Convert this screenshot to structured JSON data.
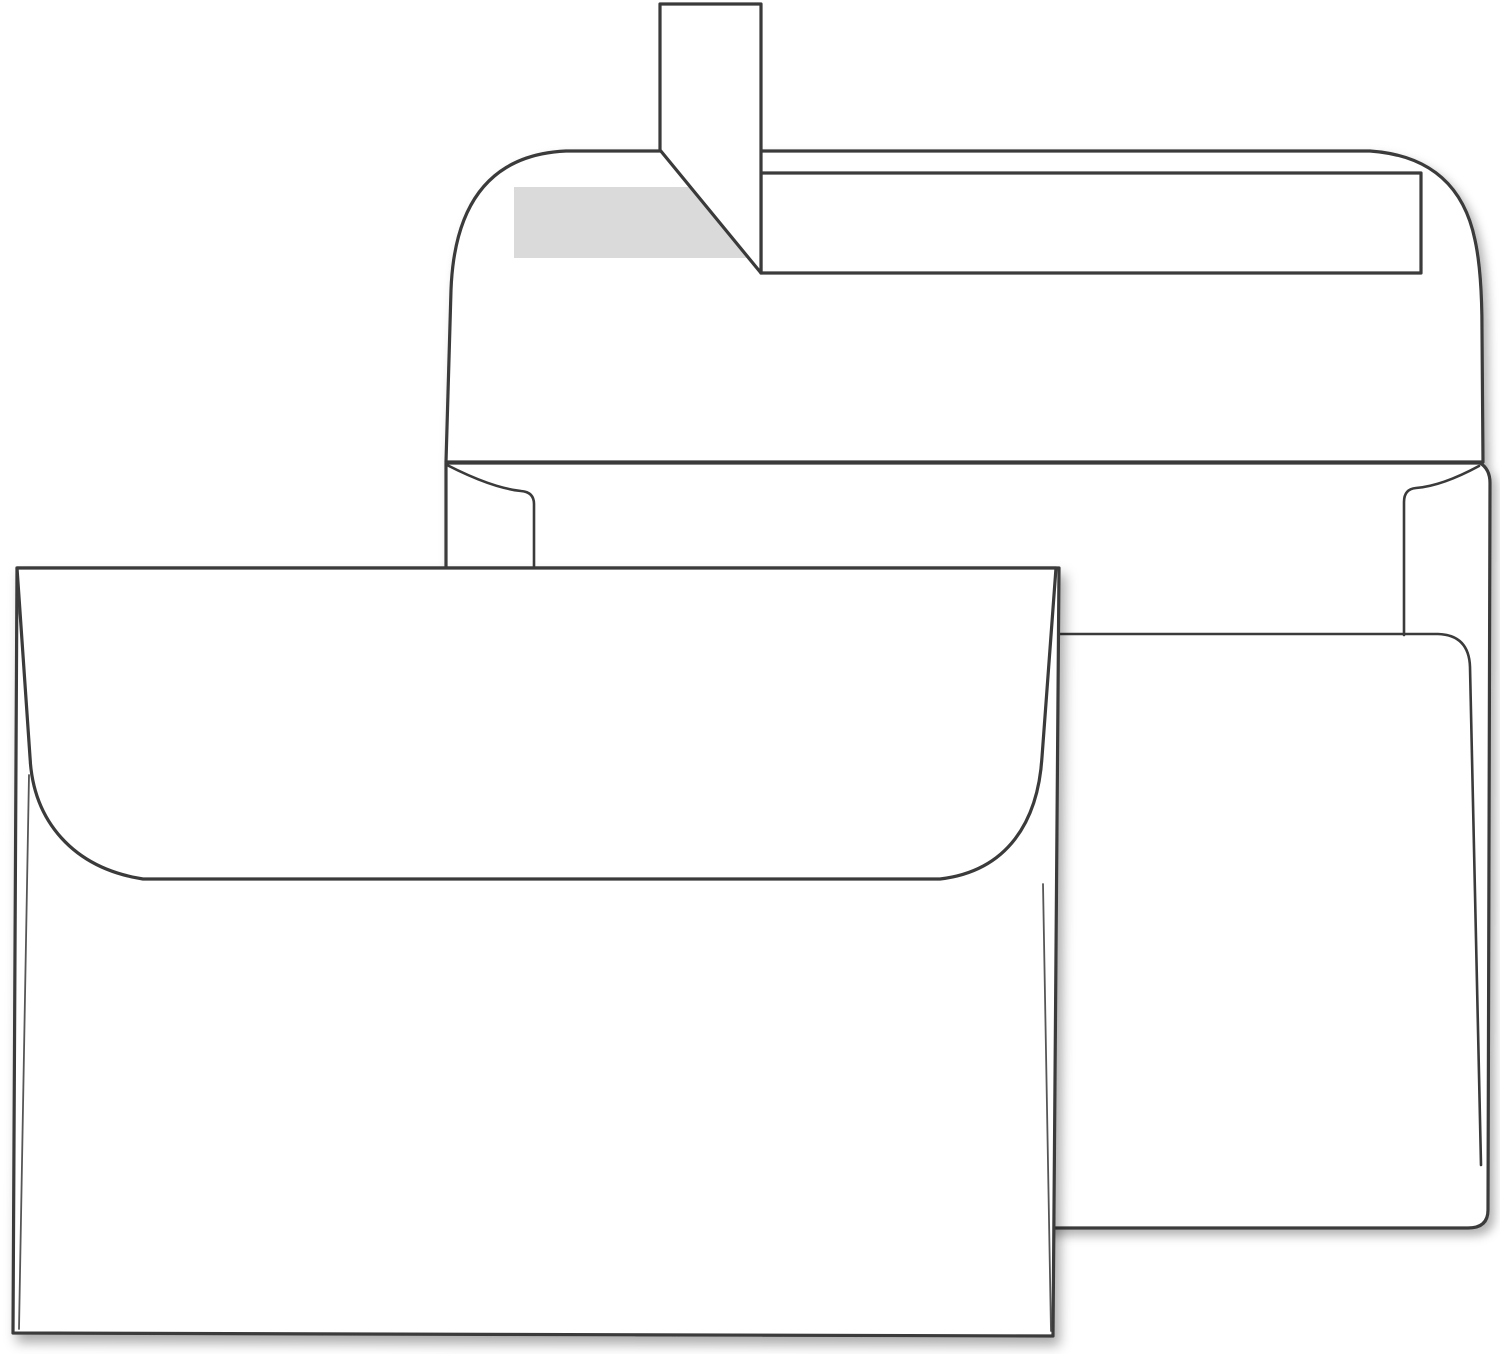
{
  "scene": {
    "title": "Two blank white envelopes product illustration",
    "background_color": "#ffffff",
    "paper_color": "#ffffff",
    "outline_color": "#3a3a3a",
    "adhesive_color": "#dadada",
    "back_envelope": {
      "view": "back side with flap open upward",
      "features": [
        "peel-and-seal release strip lifted vertically at top",
        "exposed gray adhesive strip on flap",
        "release liner band lying flat across flap",
        "left and right side flaps",
        "large bottom flap with rounded corner"
      ]
    },
    "front_envelope": {
      "view": "back side with flap closed",
      "features": [
        "rounded closed flap",
        "square flap style with curved bottom edge"
      ]
    }
  }
}
